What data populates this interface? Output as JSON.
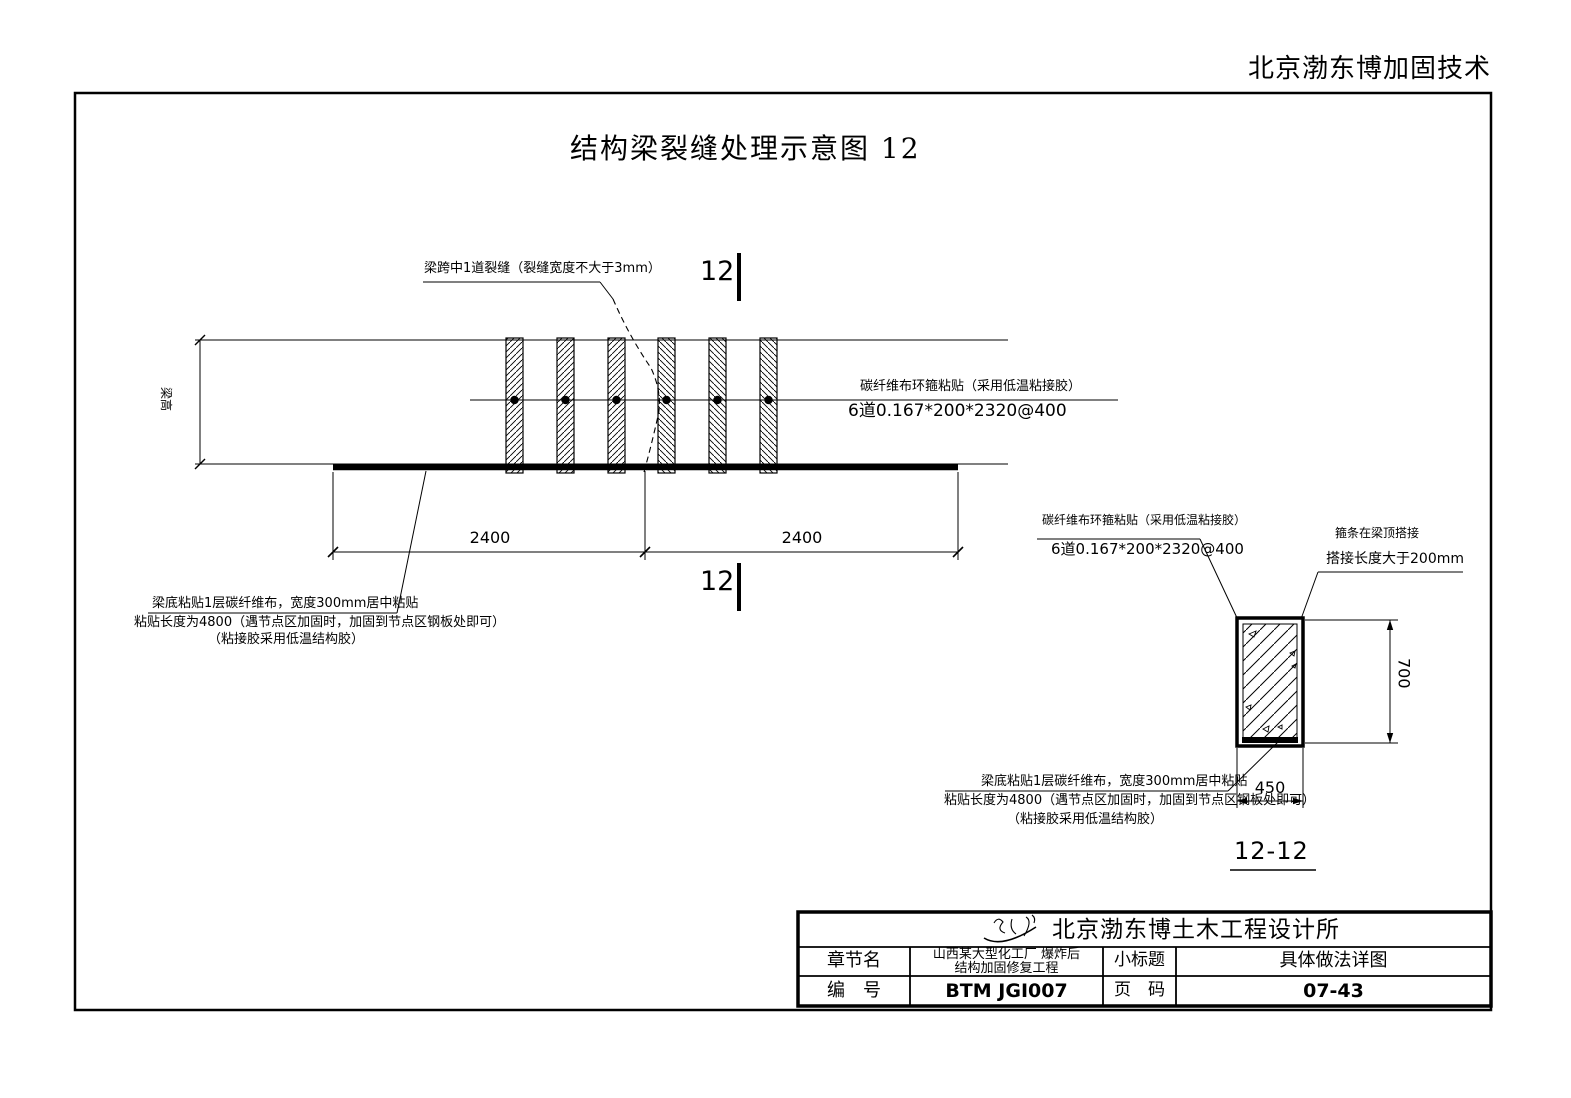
{
  "header": {
    "company_header": "北京渤东博加固技术"
  },
  "title": "结构梁裂缝处理示意图  12",
  "elevation": {
    "beam_height_label": "梁高",
    "crack_callout": "梁跨中1道裂缝（裂缝宽度不大于3mm）",
    "section_mark_top": "12",
    "section_mark_bottom": "12",
    "wrap_callout": {
      "line1": "碳纤维布环箍粘贴（采用低温粘接胶）",
      "line2": "6道0.167*200*2320@400"
    },
    "bottom_wrap_callout": {
      "line1": "梁底粘贴1层碳纤维布，宽度300mm居中粘贴",
      "line2": "粘贴长度为4800（遇节点区加固时，加固到节点区钢板处即可）",
      "line3": "（粘接胶采用低温结构胶）"
    },
    "dims": {
      "left_span": "2400",
      "right_span": "2400"
    }
  },
  "section": {
    "label": "12-12",
    "wrap_callout": {
      "line1": "碳纤维布环箍粘贴（采用低温粘接胶）",
      "line2": "6道0.167*200*2320@400"
    },
    "lap_callout": {
      "line1": "箍条在梁顶搭接",
      "line2": "搭接长度大于200mm"
    },
    "bottom_wrap_callout": {
      "line1": "梁底粘贴1层碳纤维布，宽度300mm居中粘贴",
      "line2": "粘贴长度为4800（遇节点区加固时，加固到节点区钢板处即可）",
      "line3": "（粘接胶采用低温结构胶）"
    },
    "dims": {
      "height": "700",
      "width": "450"
    }
  },
  "title_block": {
    "company": "北京渤东博土木工程设计所",
    "chapter_label": "章节名",
    "chapter_line1": "山西某大型化工厂 爆炸后",
    "chapter_line2": "结构加固修复工程",
    "subtitle_label": "小标题",
    "subtitle_value": "具体做法详图",
    "number_label": "编　号",
    "number_value": "BTM JGI007",
    "page_label": "页　码",
    "page_value": "07-43"
  }
}
